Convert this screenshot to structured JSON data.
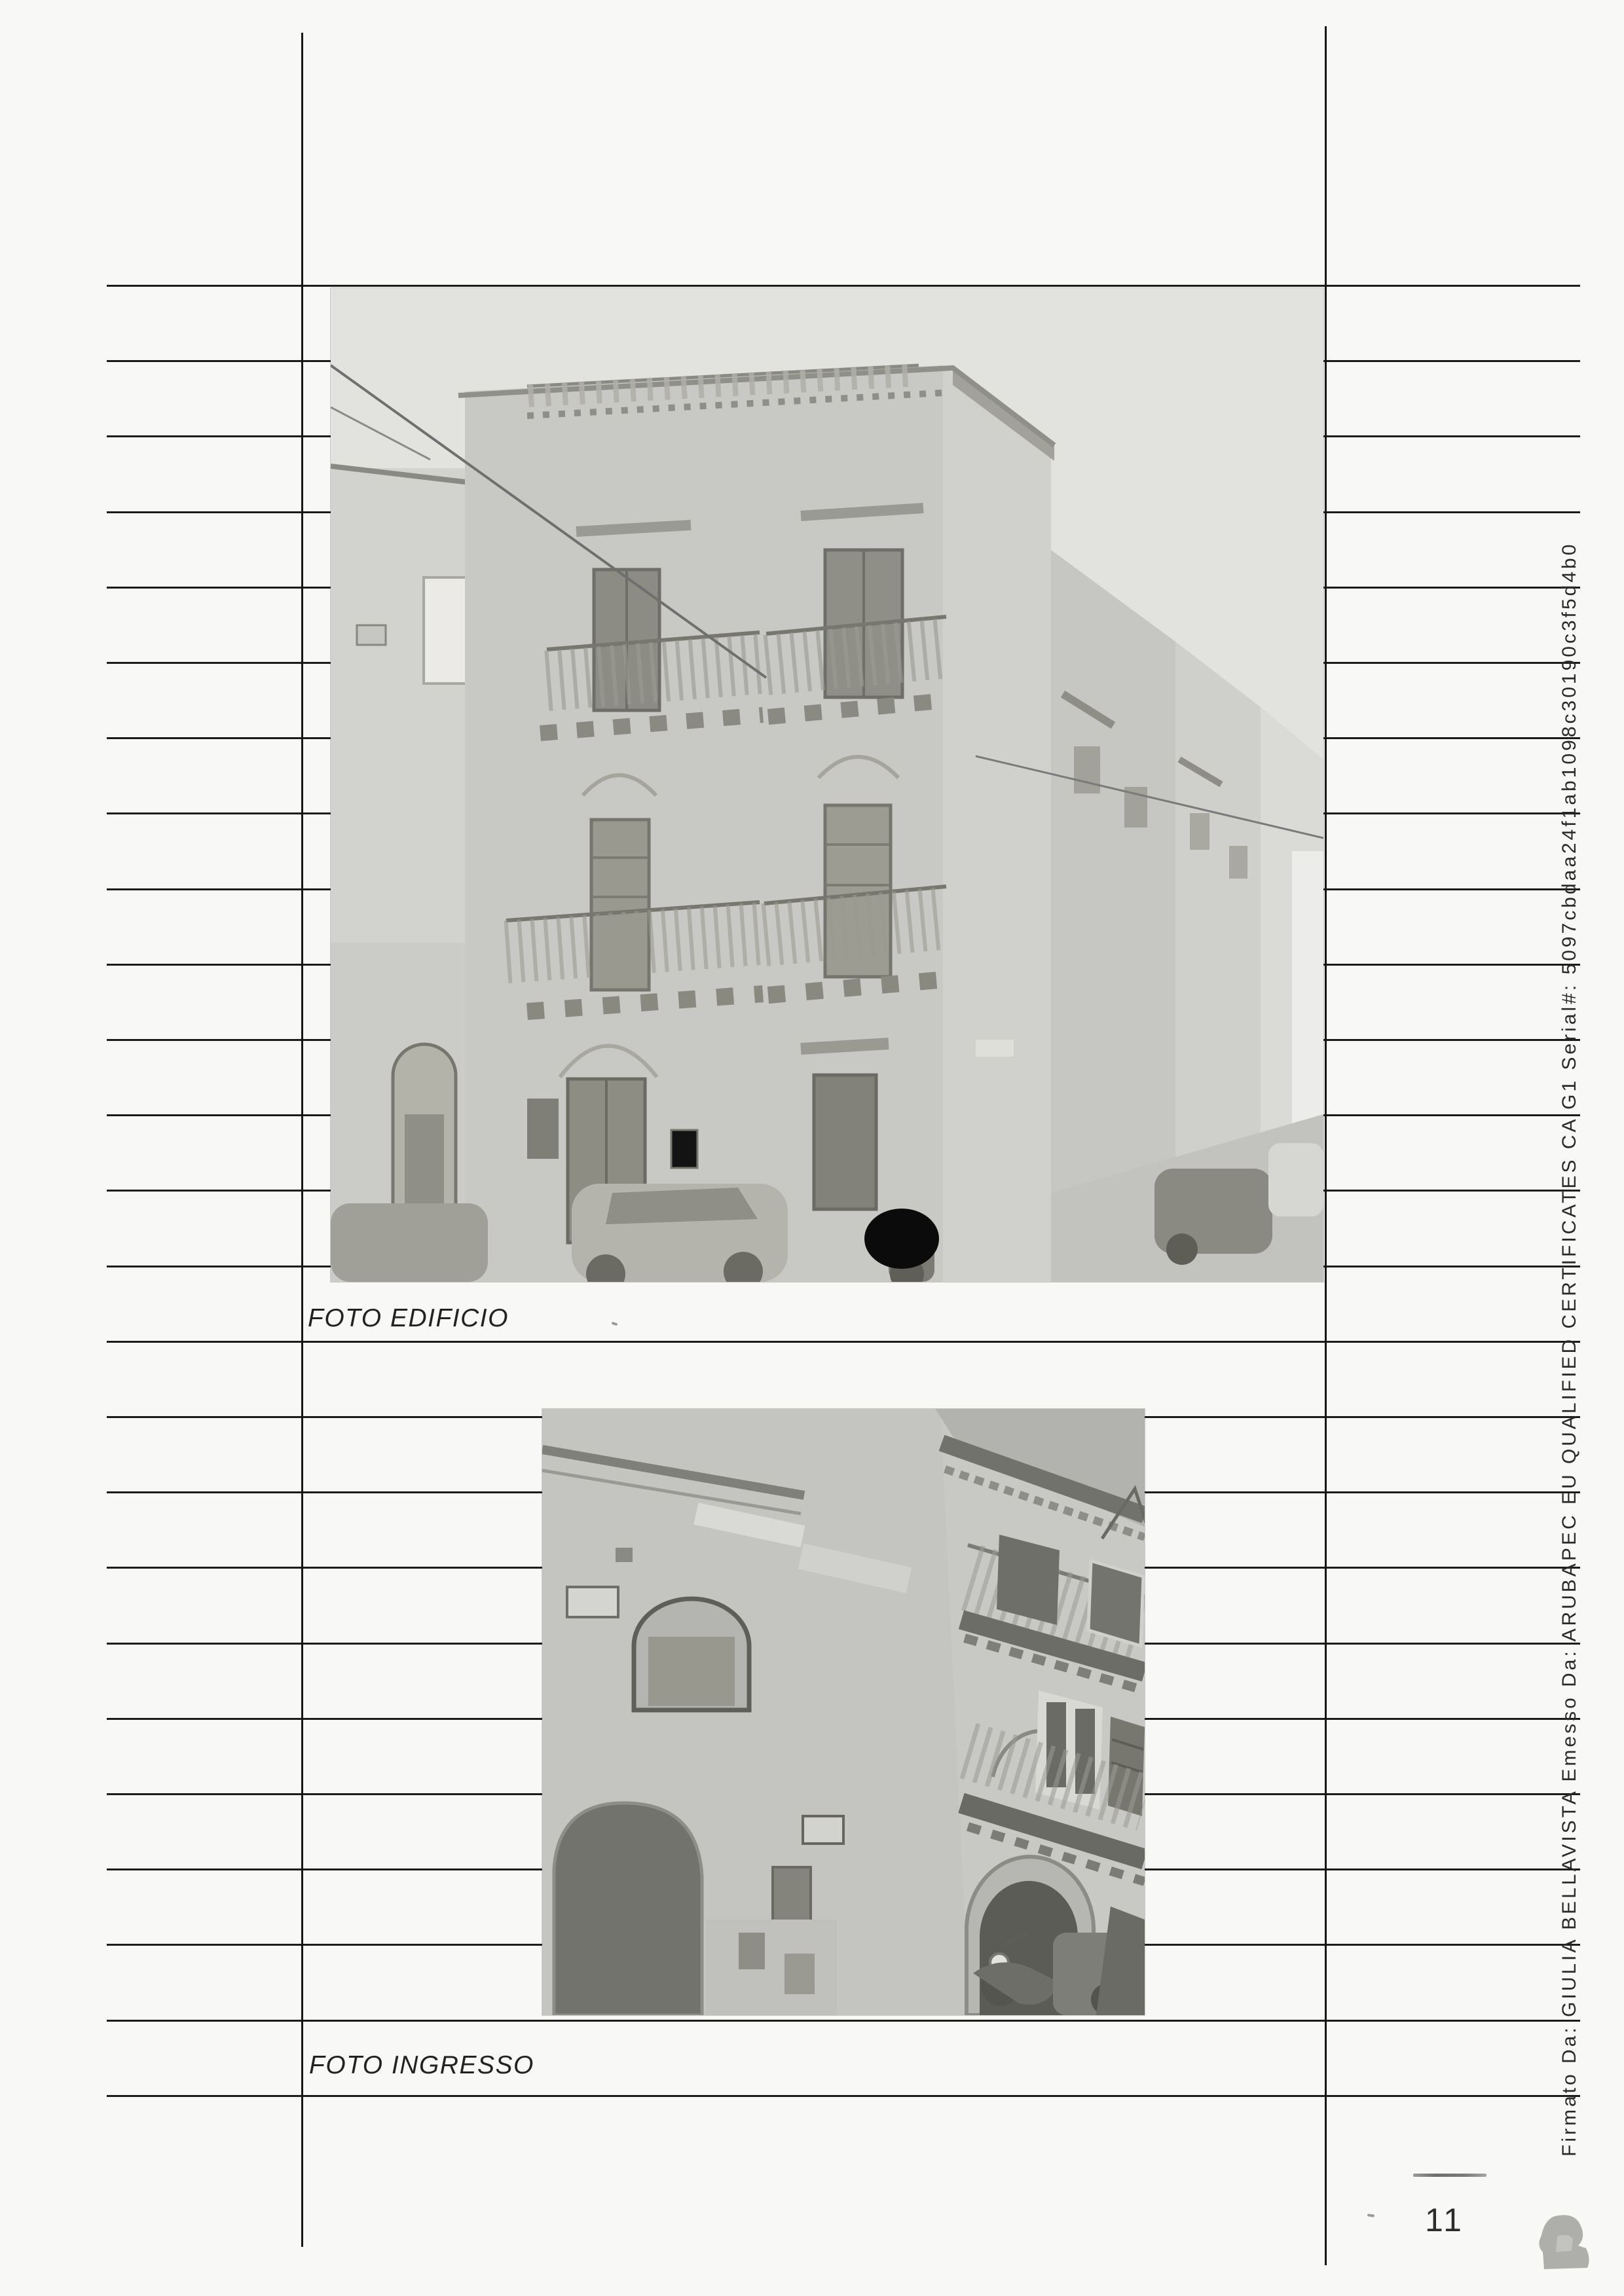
{
  "document": {
    "captions": {
      "building": "FOTO EDIFICIO",
      "entrance": "FOTO INGRESSO"
    },
    "page_number": "11",
    "signature_sidebar": "Firmato Da: GIULIA BELLAVISTA Emesso Da: ARUBAPEC EU QUALIFIED CERTIFICATES CA G1 Serial#: 5097cbdaa24f1ab1098c30190c3f5d4b0",
    "photos": [
      {
        "name": "foto-edificio",
        "description": "Black and white photo of a three-storey corner building with balconies and roof terrace, street receding to the right, parked cars at street level, licence plate covered by a black dot"
      },
      {
        "name": "foto-ingresso",
        "description": "Black and white photo of the building entrance: arched portal with dark door, balconies with shutters above, covered vehicle on the left, scooter at lower right"
      }
    ],
    "colors": {
      "ink": "#1c1c1c",
      "paper": "#f8f8f6",
      "photo_gray": "#c8c8c4",
      "redaction": "#0b0b0b"
    }
  }
}
